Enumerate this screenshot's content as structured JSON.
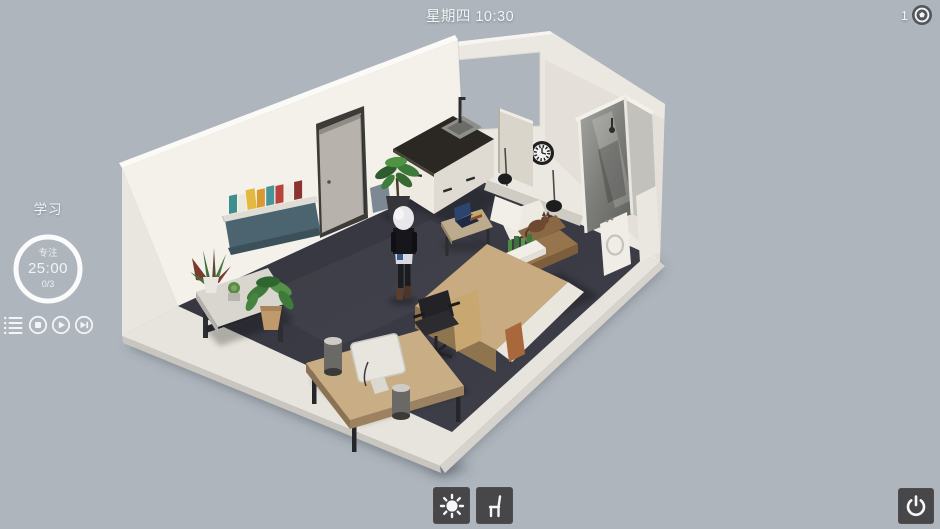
{
  "hud": {
    "top": {
      "datetime": "星期四 10:30",
      "currency_count": "1",
      "currency_icon": "coin-icon"
    },
    "left_panel": {
      "title": "学习",
      "timer_label": "专注",
      "timer_time": "25:00",
      "timer_progress": "0/3",
      "icons": [
        "playlist-icon",
        "stop-icon",
        "play-icon",
        "skip-next-icon"
      ]
    },
    "bottom_bar": {
      "icons": [
        "sun-icon",
        "chair-icon"
      ]
    },
    "power_icon": "power-icon",
    "colors": {
      "background": "#aeb5bd",
      "hud_text": "#f2f4f6",
      "button_bg": "#47474a",
      "carpet": "#3a3a45",
      "wall_left": "#f3f1ea",
      "wall_back": "#ebe8e1",
      "wood": "#c8ab80"
    }
  }
}
